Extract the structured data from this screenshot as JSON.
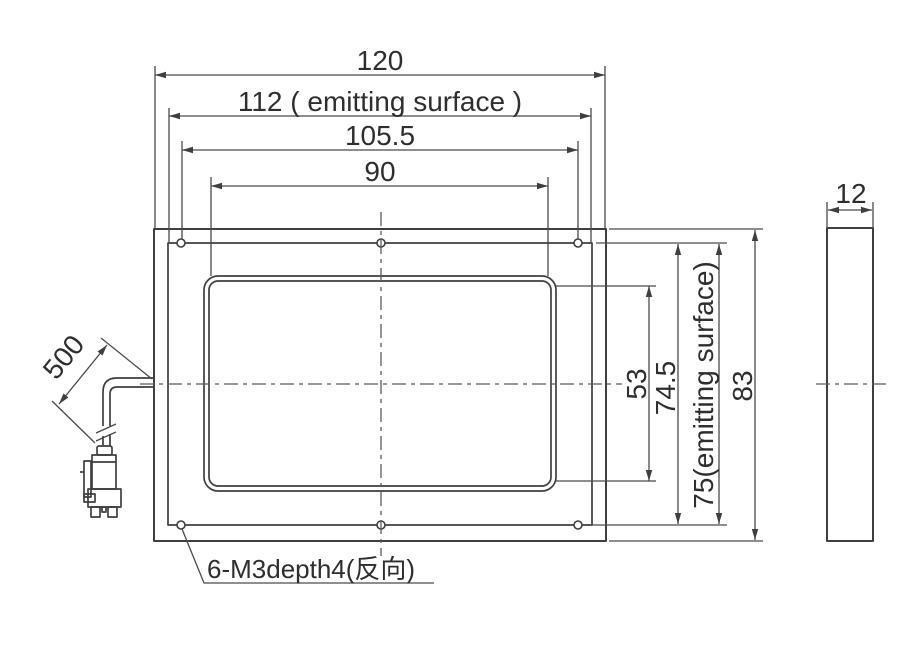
{
  "front_view": {
    "width_overall": "120",
    "width_emitting": "112 ( emitting surface )",
    "width_hole_spacing": "105.5",
    "width_window": "90",
    "height_window": "53",
    "height_hole_spacing": "74.5",
    "height_emitting": "75(emitting surface)",
    "height_overall": "83",
    "mounting_note": "6-M3depth4(反向)"
  },
  "side_view": {
    "thickness": "12"
  },
  "cable": {
    "length": "500"
  },
  "colors": {
    "line": "#3f3f3f",
    "dimension_line": "#4a4a4a",
    "background": "#ffffff"
  }
}
